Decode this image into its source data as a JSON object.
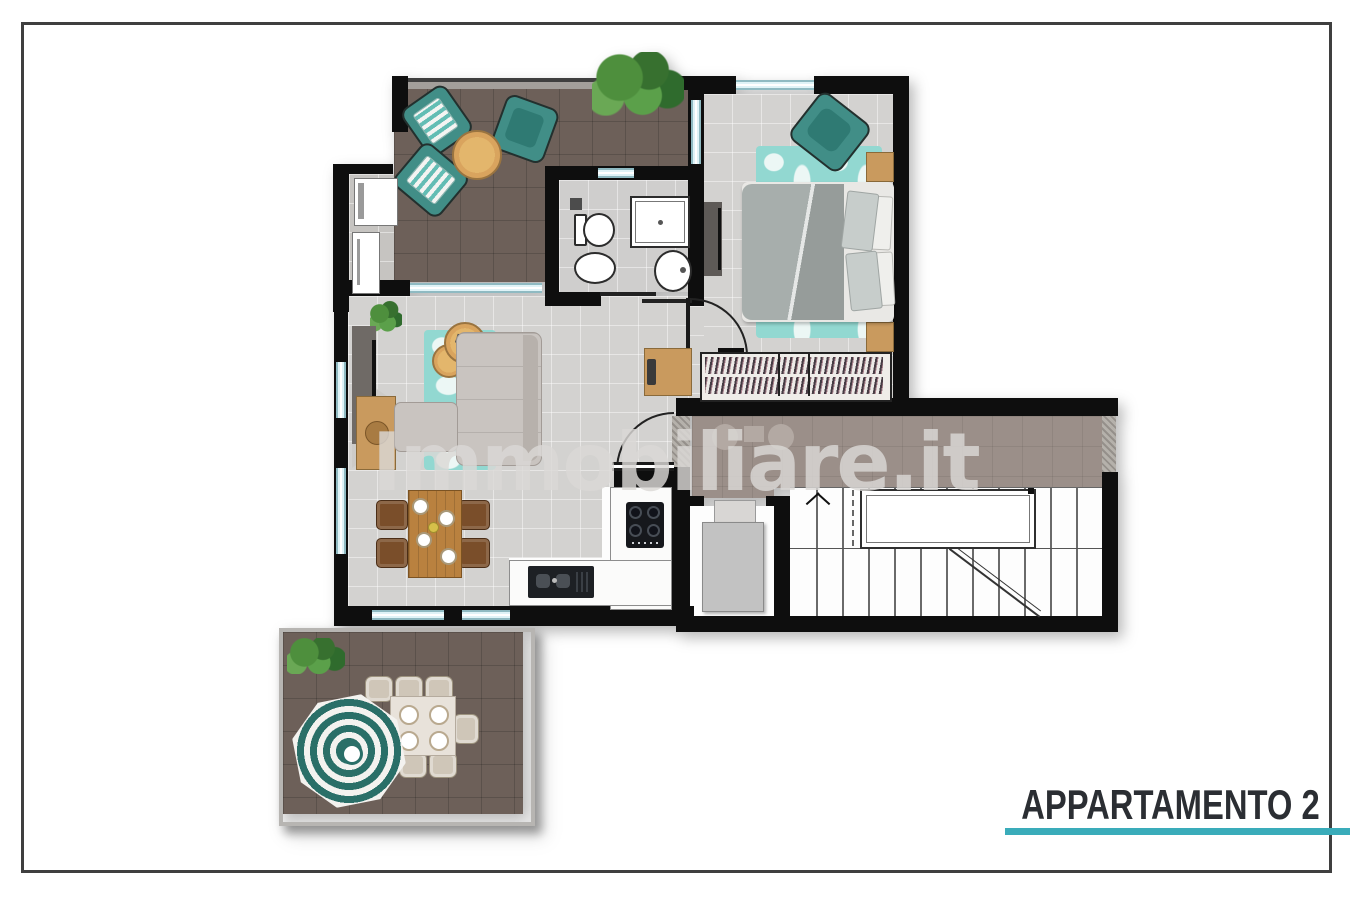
{
  "title": {
    "label": "APPARTAMENTO 2"
  },
  "watermark": {
    "brand": "Immobiliare.it"
  },
  "colors": {
    "accent_teal_line": "#3aacba",
    "title_text": "#2b2e33",
    "wall": "#0e0e0e",
    "floor_light": "#d3d2d0",
    "terrace_dark": "#6d6059",
    "corridor_taupe": "#9b8f89",
    "furniture_teal": "#418e87",
    "rug_teal": "#92d8d1",
    "wood": "#c99a5e",
    "window_glass": "#dff3f7",
    "umbrella_teal": "#2a6f68",
    "frame_border": "#3f3f3f"
  }
}
